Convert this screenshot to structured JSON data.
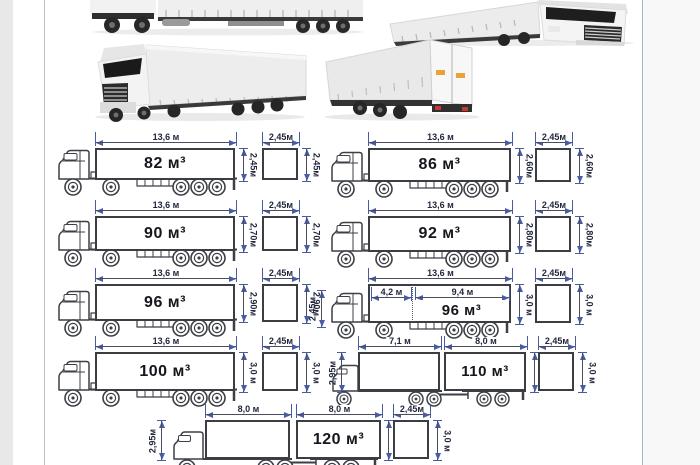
{
  "frame": {
    "left_strip_color": "#e8e8e8",
    "right_strip_color": "#f8f8f8",
    "left_line_color": "#b7c3c9",
    "right_line_color": "#9fb7c2"
  },
  "colors": {
    "dim_arrow": "#4a5ba6",
    "dim_line": "#4a4e5c",
    "dim_text": "#23273d",
    "box_outline": "#3b3d42",
    "volume_text": "#15151c"
  },
  "photos": {
    "top_left": "side-view-curtainside-truck-photo",
    "top_right": "front-angle-truck-photo",
    "mid_left": "three-quarter-front-truck-photo",
    "mid_right": "three-quarter-rear-truck-photo"
  },
  "rows": [
    {
      "items": [
        {
          "kind": "semi",
          "length": "13,6 м",
          "volume": "82 м³",
          "height": "2,45м",
          "square_width": "2,45м",
          "square_height": "2,45м"
        },
        {
          "kind": "semi",
          "length": "13,6 м",
          "volume": "86 м³",
          "height": "2,60м",
          "square_width": "2,45м",
          "square_height": "2,60м"
        }
      ]
    },
    {
      "items": [
        {
          "kind": "semi",
          "length": "13,6 м",
          "volume": "90 м³",
          "height": "2,70м",
          "square_width": "2,45м",
          "square_height": "2,70м"
        },
        {
          "kind": "semi",
          "length": "13,6 м",
          "volume": "92 м³",
          "height": "2,80м",
          "square_width": "2,45м",
          "square_height": "2,80м"
        }
      ]
    },
    {
      "items": [
        {
          "kind": "semi",
          "length": "13,6 м",
          "volume": "96 м³",
          "height": "2,90м",
          "square_width": "2,45м",
          "square_height": "2,90м"
        },
        {
          "kind": "jumbo",
          "length": "13,6 м",
          "front_length": "4,2 м",
          "rear_length": "9,4 м",
          "cab_height": "2,45м",
          "volume": "96 м³",
          "height": "3,0 м",
          "square_width": "2,45м",
          "square_height": "3,0 м"
        }
      ]
    },
    {
      "items": [
        {
          "kind": "semi",
          "length": "13,6 м",
          "volume": "100 м³",
          "height": "3,0 м",
          "square_width": "2,45м",
          "square_height": "3,0 м"
        },
        {
          "kind": "roadtrain",
          "truck_length": "7,1 м",
          "trailer_length": "8,0 м",
          "left_height": "2,95м",
          "volume": "110 м³",
          "height": "3,0 м",
          "square_width": "2,45м",
          "square_height": "3,0 м"
        }
      ]
    },
    {
      "items": [
        {
          "kind": "roadtrain",
          "truck_length": "8,0 м",
          "trailer_length": "8,0 м",
          "left_height": "2,95м",
          "volume": "120 м³",
          "height": "3,0 м",
          "square_width": "2,45м",
          "square_height": "3,0 м"
        }
      ]
    }
  ]
}
